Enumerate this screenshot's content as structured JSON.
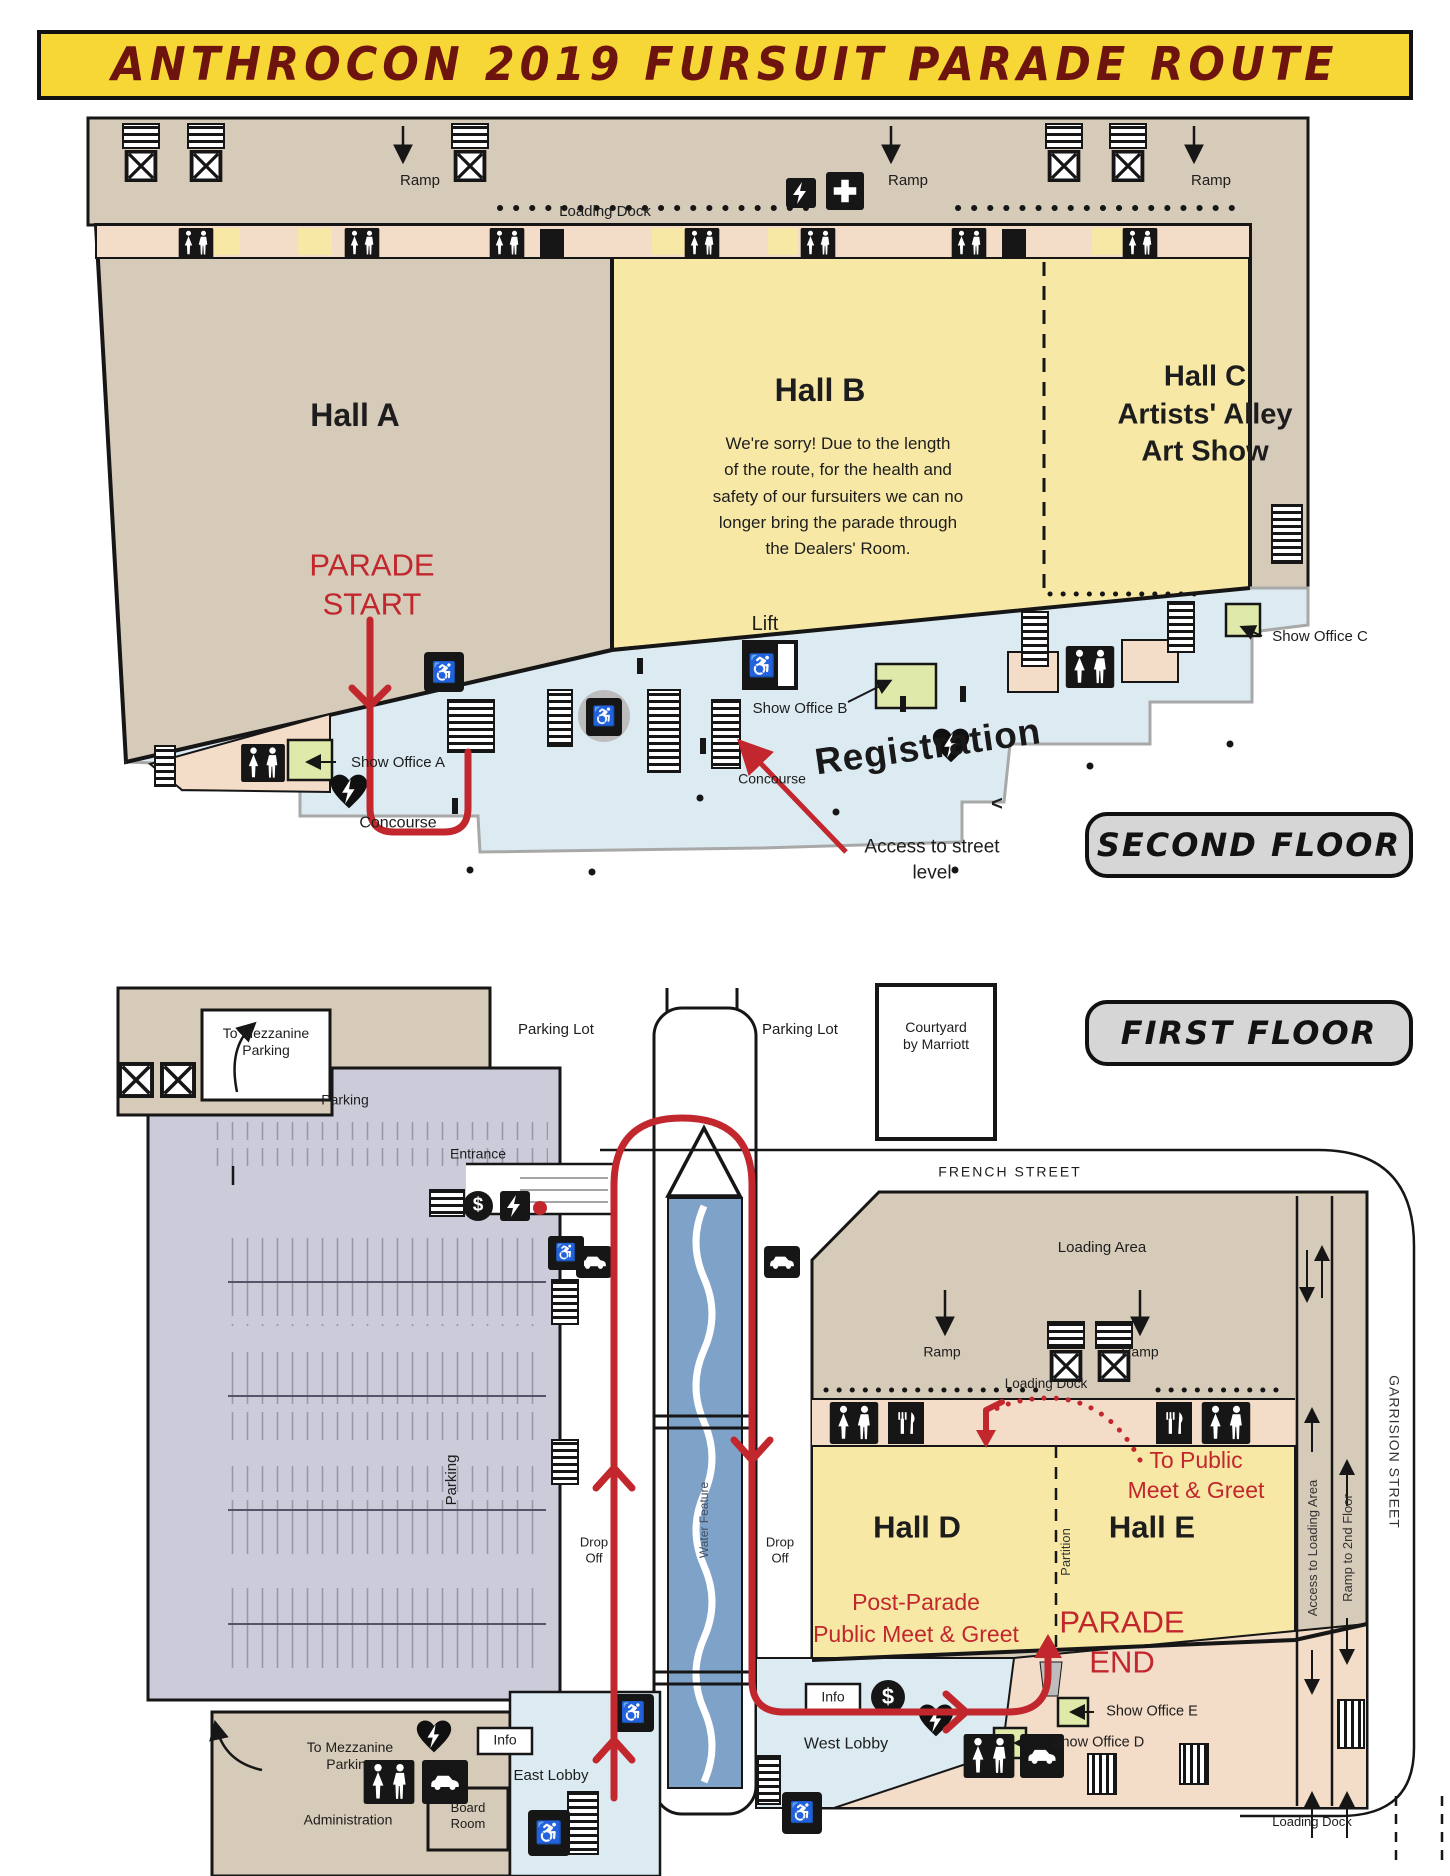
{
  "title": "ANTHROCON 2019 FURSUIT PARADE ROUTE",
  "colors": {
    "banner": "#f6d735",
    "title": "#6e140f",
    "red": "#c1272d",
    "tan": "#d6cab8",
    "yellow": "#f7e8a5",
    "blue": "#dcebf2",
    "peach": "#f3dcc8",
    "green": "#dfe9a9",
    "lav": "#cbcbd9",
    "water": "#7fa2c9",
    "badge": "#d6d6d6"
  },
  "icons": {
    "dollar": "$",
    "wheelchair": "♿",
    "less_than": "<"
  },
  "second_floor": {
    "badge": "SECOND FLOOR",
    "hall_a": "Hall A",
    "hall_b": "Hall B",
    "hall_b_note": [
      "We're sorry!  Due to the length",
      "of the route, for the health and",
      "safety of our fursuiters we can no",
      "longer bring the parade through",
      "the Dealers' Room."
    ],
    "hall_c": [
      "Hall C",
      "Artists' Alley",
      "Art Show"
    ],
    "parade_start": [
      "PARADE",
      "START"
    ],
    "lift": "Lift",
    "show_office_a": "Show Office A",
    "show_office_b": "Show Office B",
    "show_office_c": "Show Office C",
    "registration": "Registration",
    "concourse": "Concourse",
    "access_street": [
      "Access to street",
      "level"
    ],
    "ramp": "Ramp",
    "loading_dock": "Loading Dock"
  },
  "first_floor": {
    "badge": "FIRST FLOOR",
    "to_mezzanine": [
      "To Mezzanine",
      "Parking"
    ],
    "parking_lot": "Parking Lot",
    "courtyard": [
      "Courtyard",
      "by Marriott"
    ],
    "parking": "Parking",
    "entrance": "Entrance",
    "french_street": "FRENCH STREET",
    "loading_area": "Loading Area",
    "ramp": "Ramp",
    "loading_dock": "Loading Dock",
    "garrision_street": "GARRISION STREET",
    "hall_d": "Hall D",
    "hall_e": "Hall E",
    "partition": "Partition",
    "to_public": [
      "To Public",
      "Meet & Greet"
    ],
    "post_parade": [
      "Post-Parade",
      "Public Meet & Greet"
    ],
    "parade_end": [
      "PARADE",
      "END"
    ],
    "water_feature": "Water Feature",
    "drop_off": [
      "Drop",
      "Off"
    ],
    "access_loading": "Access to Loading Area",
    "ramp_2nd": "Ramp to 2nd Floor",
    "info": "Info",
    "west_lobby": "West Lobby",
    "east_lobby": "East Lobby",
    "show_office_d": "Show Office D",
    "show_office_e": "Show Office E",
    "board_room": [
      "Board",
      "Room"
    ],
    "administration": "Administration"
  }
}
